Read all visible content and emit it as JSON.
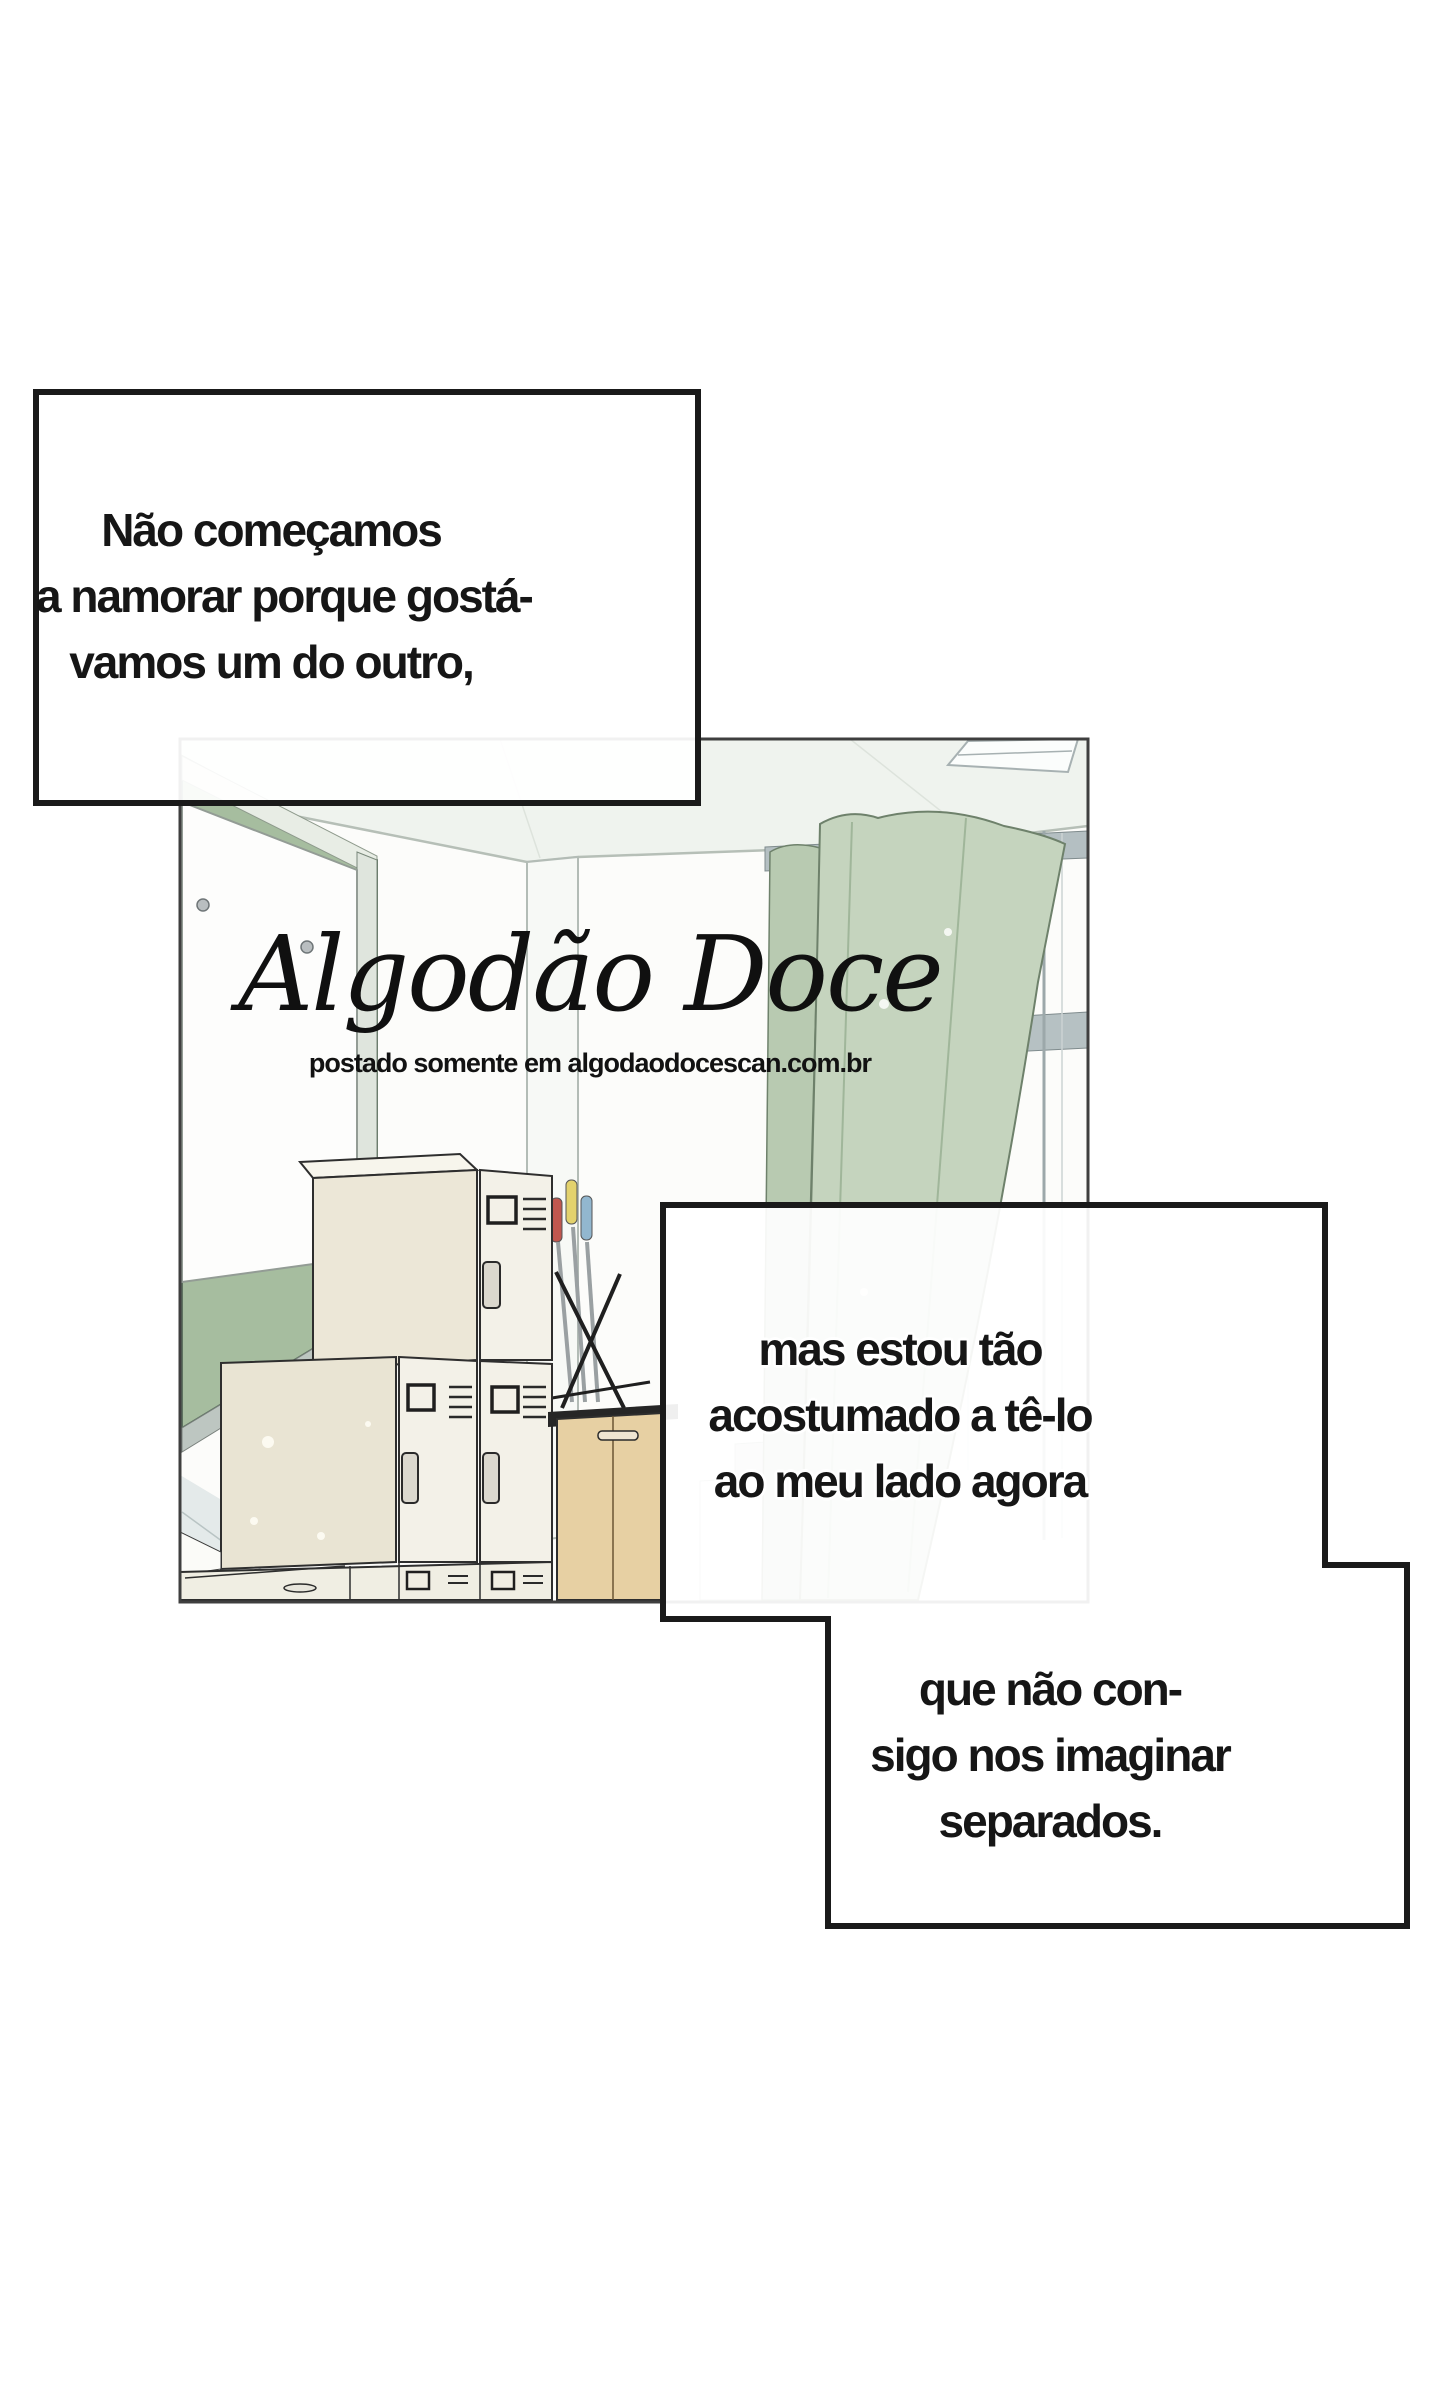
{
  "comic_page": {
    "captions": [
      {
        "id": "caption-top-left",
        "lines": [
          "Não começamos",
          "a namorar porque gostá-",
          "vamos um do outro,"
        ]
      },
      {
        "id": "caption-middle-right",
        "lines": [
          "mas estou tão",
          "acostumado a tê-lo",
          "ao meu lado agora"
        ]
      },
      {
        "id": "caption-bottom-right",
        "lines": [
          "que não con-",
          "sigo nos imaginar",
          "separados."
        ]
      }
    ],
    "watermark": {
      "title": "Algodão Doce",
      "subtitle": "postado somente em algodaodocescan.com.br"
    },
    "colors": {
      "ink": "#161616",
      "caption_border": "#1a1a1a",
      "caption_fill": "rgba(255,255,255,0.93)",
      "chalkboard_green": "#a6bd9f",
      "curtain_green": "#c5d4be",
      "locker_cream": "#ece7d7",
      "cabinet_wood": "#e7d0a3"
    }
  }
}
